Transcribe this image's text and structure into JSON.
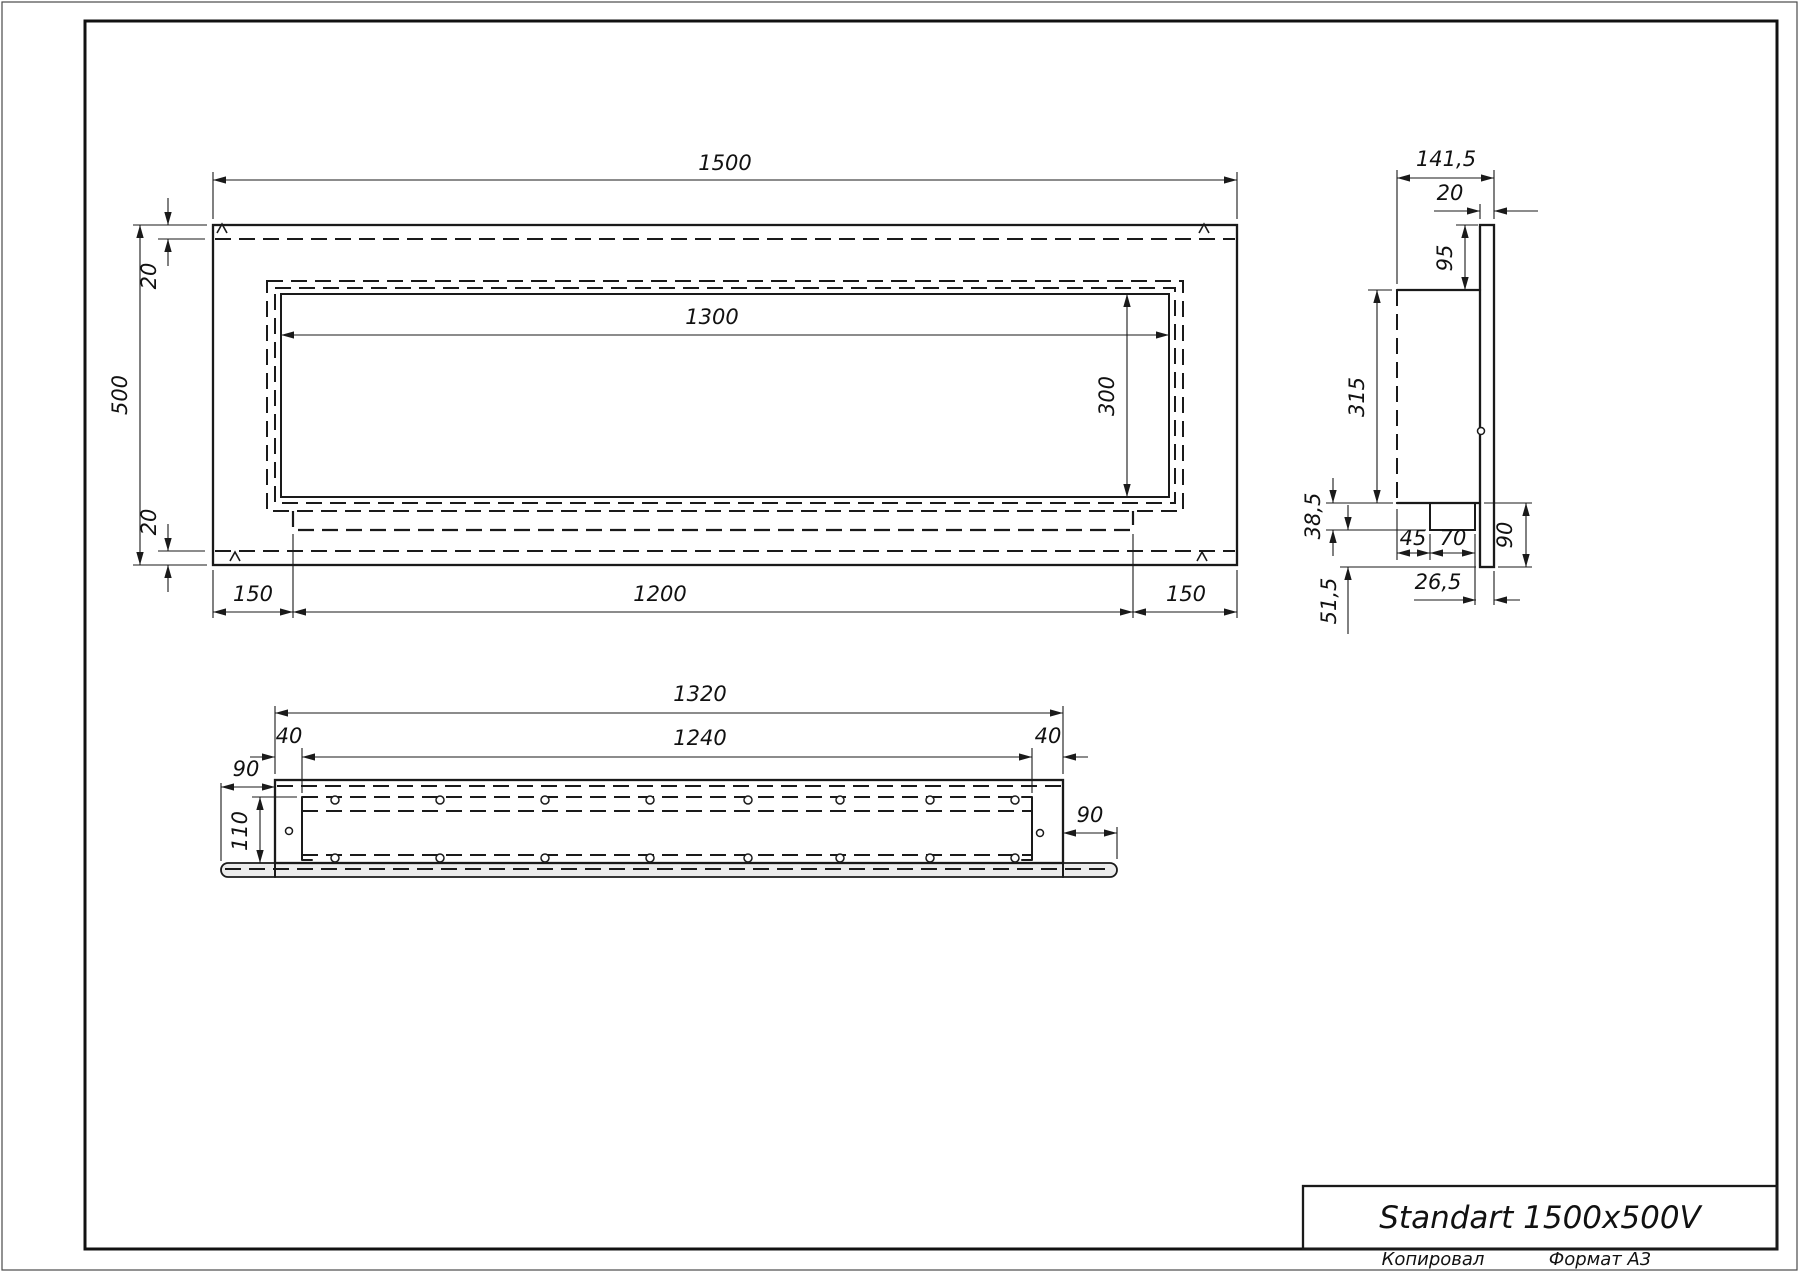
{
  "sheet": {
    "title": "Standart 1500x500V",
    "footer_left": "Копировал",
    "footer_right": "Формат А3"
  },
  "front_view": {
    "dim_width": "1500",
    "dim_height": "500",
    "dim_margin_top": "20",
    "dim_margin_bottom": "20",
    "dim_opening_width": "1300",
    "dim_opening_height": "300",
    "dim_side_left": "150",
    "dim_tray": "1200",
    "dim_side_right": "150"
  },
  "side_view": {
    "dim_depth": "141,5",
    "dim_flange": "20",
    "dim_top_offset": "95",
    "dim_body_height": "315",
    "dim_step": "38,5",
    "dim_burner_offset": "45",
    "dim_burner_width": "70",
    "dim_lower_height": "90",
    "dim_lip": "26,5",
    "dim_bottom_offset": "51,5"
  },
  "plan_view": {
    "dim_width": "1320",
    "dim_cavity": "1240",
    "dim_wall_left": "40",
    "dim_wall_right": "40",
    "dim_plate_left": "90",
    "dim_depth": "110",
    "dim_plate_right": "90"
  }
}
